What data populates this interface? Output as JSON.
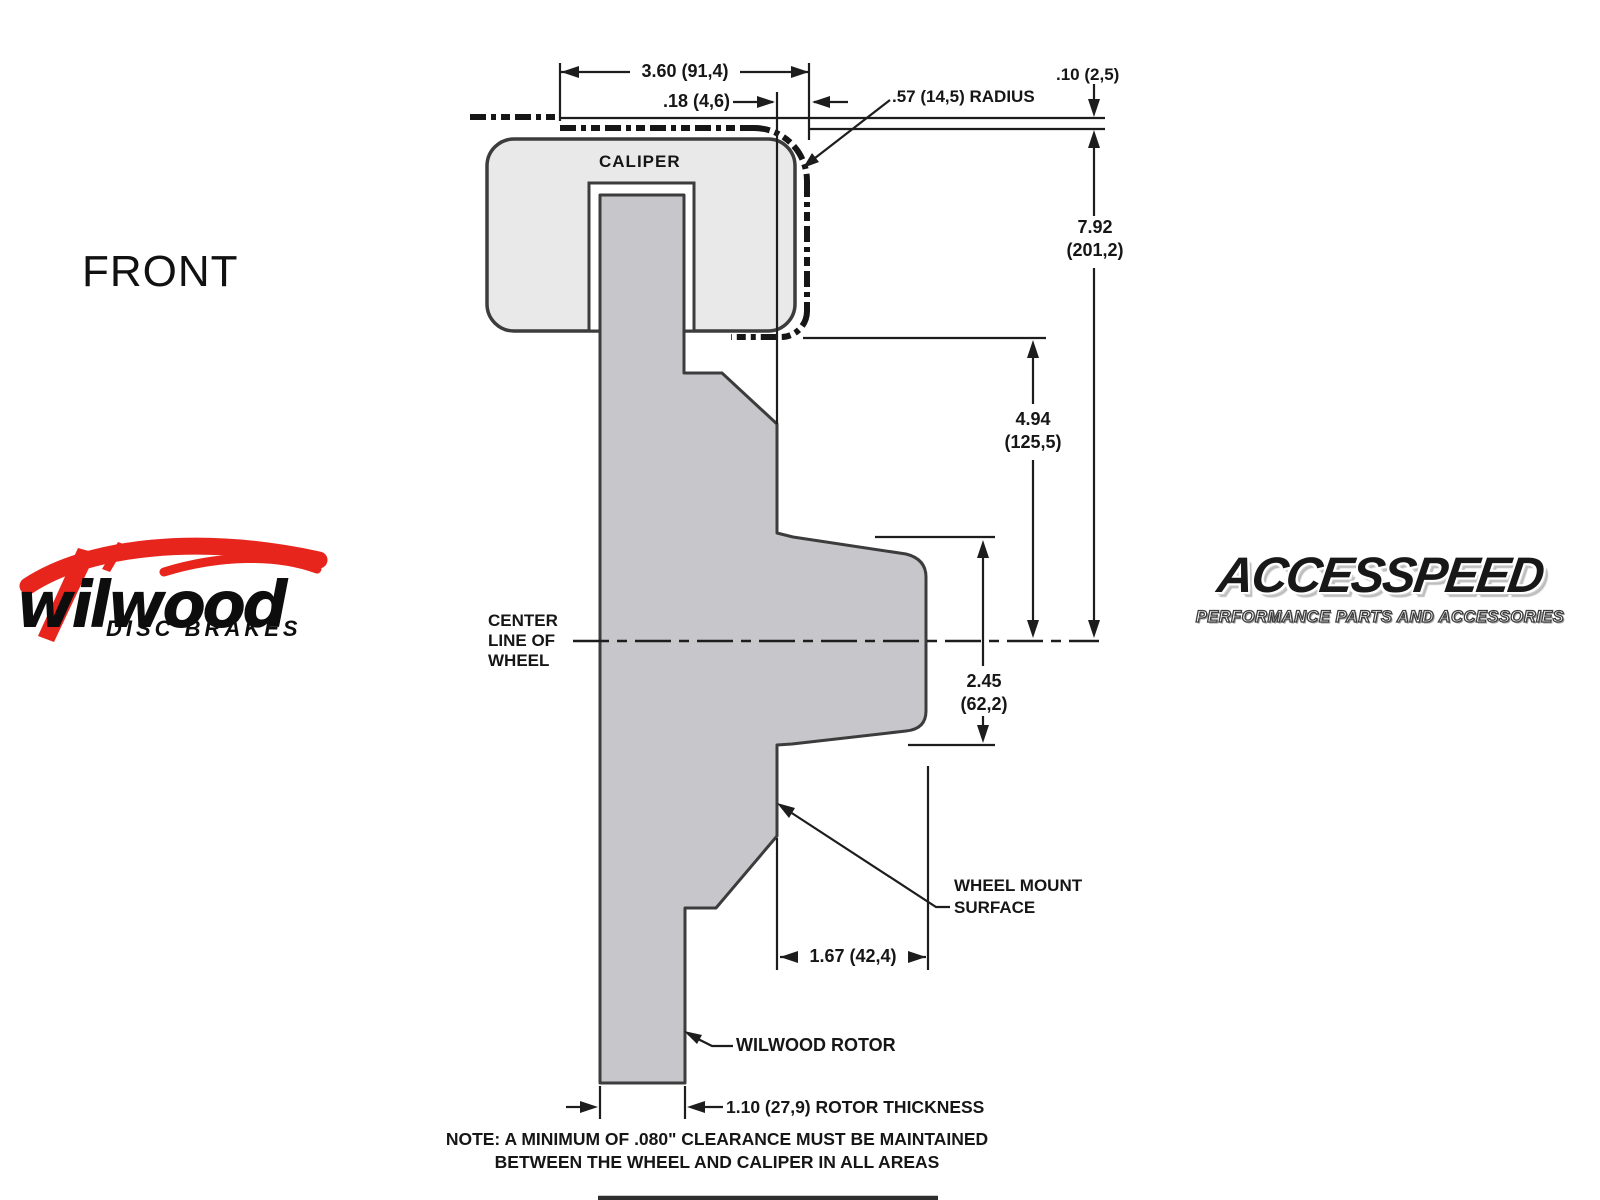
{
  "view_label": "FRONT",
  "diagram": {
    "caliper": "CALIPER",
    "centerline_line1": "CENTER",
    "centerline_line2": "LINE OF",
    "centerline_line3": "WHEEL",
    "wheel_mount_line1": "WHEEL MOUNT",
    "wheel_mount_line2": "SURFACE",
    "rotor_label": "WILWOOD ROTOR",
    "note_line1": "NOTE: A MINIMUM OF .080\" CLEARANCE MUST BE MAINTAINED",
    "note_line2": "BETWEEN THE WHEEL AND CALIPER IN ALL AREAS",
    "dim_width": "3.60 (91,4)",
    "dim_clearance": ".18 (4,6)",
    "dim_radius": ".57 (14,5) RADIUS",
    "dim_lip": ".10 (2,5)",
    "dim_total_in": "7.92",
    "dim_total_mm": "(201,2)",
    "dim_upper_in": "4.94",
    "dim_upper_mm": "(125,5)",
    "dim_lower_in": "2.45",
    "dim_lower_mm": "(62,2)",
    "dim_hat_depth": "1.67 (42,4)",
    "dim_rotor_thickness": "1.10 (27,9) ROTOR THICKNESS"
  },
  "logos": {
    "wilwood_name": "wilwood",
    "wilwood_sub": "DISC BRAKES",
    "accesspeed_name": "ACCESSPEED",
    "accesspeed_sub": "PERFORMANCE PARTS AND ACCESSORIES"
  },
  "colors": {
    "accent_red": "#e8251d",
    "line": "#1d1d1d",
    "caliper_fill": "#e9e9e9",
    "rotor_fill": "#c6c6cb"
  }
}
